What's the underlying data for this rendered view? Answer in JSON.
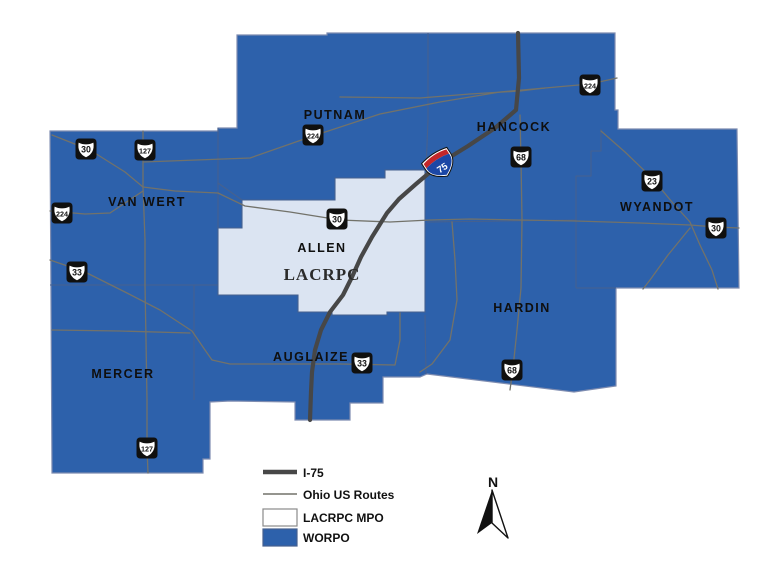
{
  "map": {
    "counties": [
      {
        "name": "PUTNAM"
      },
      {
        "name": "VAN WERT"
      },
      {
        "name": "ALLEN"
      },
      {
        "name": "HANCOCK"
      },
      {
        "name": "WYANDOT"
      },
      {
        "name": "HARDIN"
      },
      {
        "name": "MERCER"
      },
      {
        "name": "AUGLAIZE"
      }
    ],
    "mpo_label": "LACRPC",
    "interstate_shield": {
      "route": "75"
    },
    "us_route_shields": [
      {
        "route": "30"
      },
      {
        "route": "127"
      },
      {
        "route": "224"
      },
      {
        "route": "33"
      },
      {
        "route": "224"
      },
      {
        "route": "30"
      },
      {
        "route": "68"
      },
      {
        "route": "224"
      },
      {
        "route": "23"
      },
      {
        "route": "30"
      },
      {
        "route": "68"
      },
      {
        "route": "33"
      },
      {
        "route": "127"
      }
    ],
    "colors": {
      "worpo_fill": "#2d61ab",
      "lacrpc_fill": "#dbe4f2",
      "county_line": "#46618f",
      "us_route_line": "#72726a",
      "interstate_line": "#474747",
      "interstate_red": "#c3272b",
      "interstate_blue": "#1b47a6"
    }
  },
  "legend": {
    "items": [
      {
        "label": "I-75",
        "swatch": "thick-line"
      },
      {
        "label": "Ohio US Routes",
        "swatch": "thin-line"
      },
      {
        "label": "LACRPC MPO",
        "swatch": "white-box"
      },
      {
        "label": "WORPO",
        "swatch": "blue-box"
      }
    ]
  },
  "north_arrow": {
    "label": "N"
  }
}
